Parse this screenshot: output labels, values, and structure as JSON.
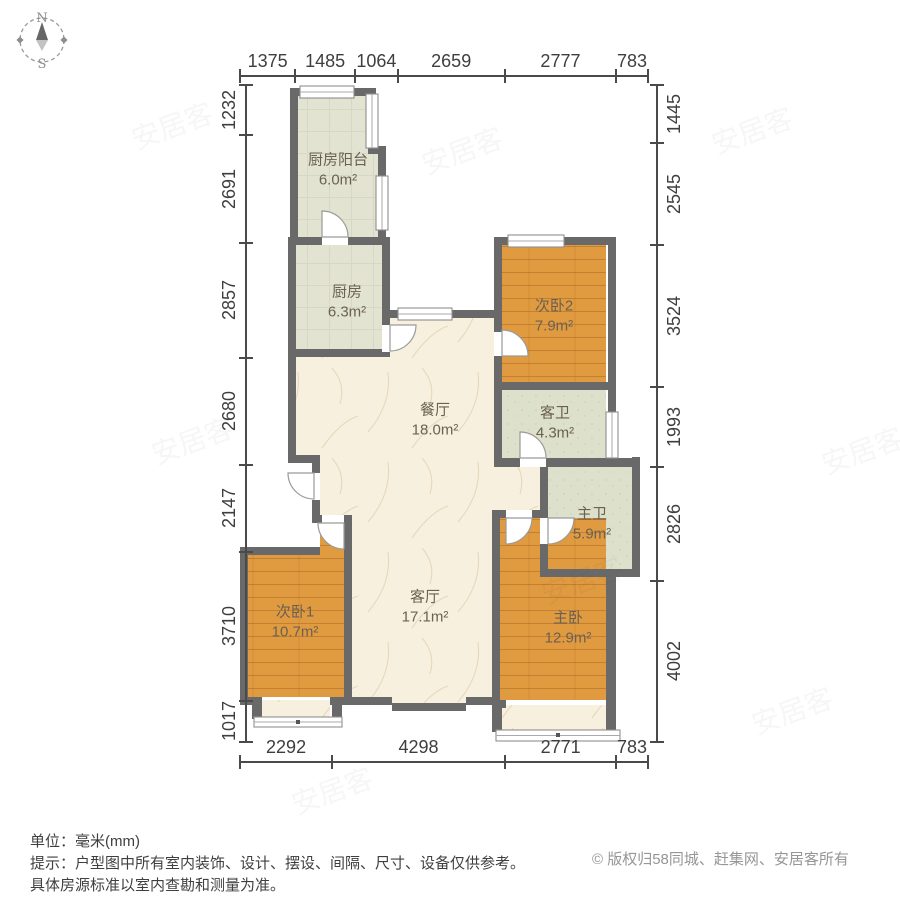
{
  "compass": {
    "north": "N",
    "south": "S"
  },
  "dimensions": {
    "top": [
      1375,
      1485,
      1064,
      2659,
      2777,
      783
    ],
    "left": [
      1232,
      2691,
      2857,
      2680,
      2147,
      3710,
      1017
    ],
    "right": [
      1445,
      2545,
      3524,
      1993,
      2826,
      4002
    ],
    "bottom": [
      2292,
      4298,
      2771,
      783
    ]
  },
  "rooms": [
    {
      "id": "kitchen-balcony",
      "name": "厨房阳台",
      "area": "6.0m²"
    },
    {
      "id": "kitchen",
      "name": "厨房",
      "area": "6.3m²"
    },
    {
      "id": "bedroom2",
      "name": "次卧2",
      "area": "7.9m²"
    },
    {
      "id": "dining-room",
      "name": "餐厅",
      "area": "18.0m²"
    },
    {
      "id": "guest-bathroom",
      "name": "客卫",
      "area": "4.3m²"
    },
    {
      "id": "master-bathroom",
      "name": "主卫",
      "area": "5.9m²"
    },
    {
      "id": "bedroom1",
      "name": "次卧1",
      "area": "10.7m²"
    },
    {
      "id": "living-room",
      "name": "客厅",
      "area": "17.1m²"
    },
    {
      "id": "master-bedroom",
      "name": "主卧",
      "area": "12.9m²"
    }
  ],
  "footer": {
    "unit_label": "单位：毫米(mm)",
    "tip_line1": "提示：户型图中所有室内装饰、设计、摆设、间隔、尺寸、设备仅供参考。",
    "tip_line2": "具体房源标准以室内查勘和测量为准。",
    "copyright": "© 版权归58同城、赶集网、安居客所有"
  },
  "watermark": "安居客",
  "colors": {
    "wall": "#696969",
    "wood": "#e09a40",
    "tile": "#e2e3d0",
    "bath_tile": "#dde0ca",
    "marble": "#f7f0de",
    "window": "#ffffff"
  }
}
